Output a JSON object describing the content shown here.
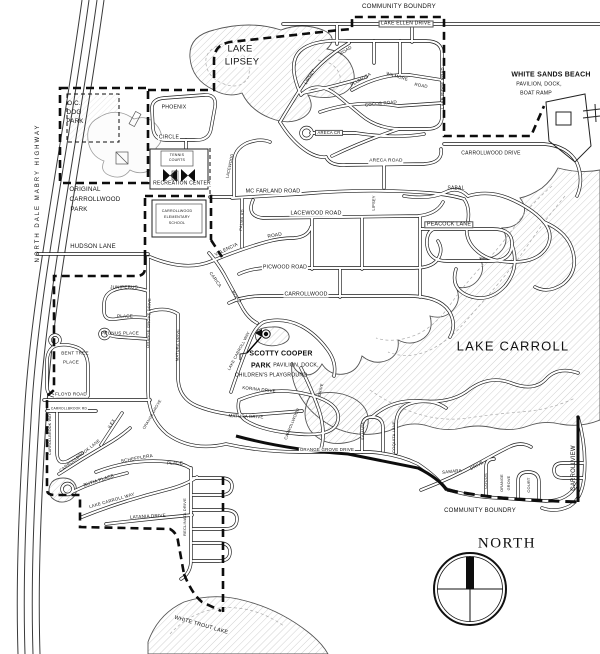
{
  "colors": {
    "ink": "#1b1b1b",
    "water_hatch": "#c4c4c4",
    "background": "#ffffff"
  },
  "map": {
    "labels": [
      {
        "id": "community-boundry-top",
        "t": "COMMUNITY BOUNDRY",
        "x": 399,
        "y": 7,
        "s": 6.2
      },
      {
        "id": "lake-ellen-drive",
        "t": "LAKE ELLEN DRIVE",
        "x": 406,
        "y": 24,
        "s": 5,
        "bx": 1
      },
      {
        "id": "white-sands-beach",
        "t": "WHITE SANDS BEACH",
        "x": 551,
        "y": 75,
        "s": 7,
        "w": 700
      },
      {
        "id": "white-sands-sub1",
        "t": "PAVILION, DOCK,",
        "x": 539,
        "y": 85,
        "s": 5.2
      },
      {
        "id": "white-sands-sub2",
        "t": "BOAT RAMP",
        "x": 536,
        "y": 94,
        "s": 5.2
      },
      {
        "id": "lake-lipsey-1",
        "t": "LAKE",
        "x": 240,
        "y": 49,
        "s": 9.5,
        "bg": 1
      },
      {
        "id": "lake-lipsey-2",
        "t": "LIPSEY",
        "x": 242,
        "y": 62,
        "s": 9.5,
        "bg": 1
      },
      {
        "id": "oc-dog-park-1",
        "t": "O.C.",
        "x": 74,
        "y": 104,
        "s": 6.2
      },
      {
        "id": "oc-dog-park-2",
        "t": "DOG",
        "x": 74,
        "y": 113,
        "s": 6.2
      },
      {
        "id": "oc-dog-park-3",
        "t": "PARK",
        "x": 75,
        "y": 122,
        "s": 6.2
      },
      {
        "id": "phoenix",
        "t": "PHOENIX",
        "x": 174,
        "y": 108,
        "s": 5.2,
        "bg": 1
      },
      {
        "id": "phoenix-circle",
        "t": "CIRCLE",
        "x": 169,
        "y": 138,
        "s": 5.2,
        "bg": 1
      },
      {
        "id": "tennis-1",
        "t": "TENNIS",
        "x": 177,
        "y": 156,
        "s": 3.6
      },
      {
        "id": "tennis-2",
        "t": "COURTS",
        "x": 177,
        "y": 161,
        "s": 3.6
      },
      {
        "id": "recreation-center",
        "t": "RECREATION CENTER",
        "x": 182,
        "y": 184,
        "s": 5,
        "bg": 1
      },
      {
        "id": "original-park-1",
        "t": "ORIGINAL",
        "x": 85,
        "y": 190,
        "s": 6.2
      },
      {
        "id": "original-park-2",
        "t": "CARROLLWOOD",
        "x": 95,
        "y": 200,
        "s": 6.2
      },
      {
        "id": "original-park-3",
        "t": "PARK",
        "x": 79,
        "y": 210,
        "s": 6.2
      },
      {
        "id": "school-1",
        "t": "CARROLLWOOD",
        "x": 177,
        "y": 212,
        "s": 3.6
      },
      {
        "id": "school-2",
        "t": "ELEMENTARY",
        "x": 177,
        "y": 218,
        "s": 3.6
      },
      {
        "id": "school-3",
        "t": "SCHOOL",
        "x": 177,
        "y": 224,
        "s": 3.6
      },
      {
        "id": "mc-farland-road",
        "t": "MC FARLAND ROAD",
        "x": 273,
        "y": 192,
        "s": 5.4,
        "bg": 1
      },
      {
        "id": "lacewood-road",
        "t": "LACEWOOD ROAD",
        "x": 316,
        "y": 214,
        "s": 5.4,
        "bg": 1
      },
      {
        "id": "lacewood-vert",
        "t": "LACEWOOD",
        "x": 230,
        "y": 166,
        "r": -78,
        "s": 4
      },
      {
        "id": "lipsey-vert",
        "t": "LIPSEY",
        "x": 374,
        "y": 203,
        "r": -88,
        "s": 4
      },
      {
        "id": "lipsey-road-1",
        "t": "LIPSEY",
        "x": 310,
        "y": 77,
        "r": -60,
        "s": 4.4
      },
      {
        "id": "lipsey-road-2",
        "t": "ROAD",
        "x": 346,
        "y": 51,
        "r": -32,
        "s": 4.4
      },
      {
        "id": "plumosa",
        "t": "PLUMOSA",
        "x": 361,
        "y": 80,
        "r": -30,
        "s": 4.4
      },
      {
        "id": "wilmore-1",
        "t": "WILMORE",
        "x": 397,
        "y": 77,
        "r": 16,
        "s": 4.4
      },
      {
        "id": "wilmore-2",
        "t": "ROAD",
        "x": 421,
        "y": 86,
        "r": 10,
        "s": 4.4
      },
      {
        "id": "cocos-road",
        "t": "COCOS ROAD",
        "x": 381,
        "y": 104,
        "r": -6,
        "s": 4.4
      },
      {
        "id": "areca-cr",
        "t": "ARECA CR",
        "x": 329,
        "y": 133,
        "s": 4.2,
        "bx": 1
      },
      {
        "id": "areca-road",
        "t": "ARECA ROAD",
        "x": 386,
        "y": 162,
        "s": 4.8,
        "bg": 1
      },
      {
        "id": "lake-ridge-road",
        "t": "LAKE RIDGE ROAD",
        "x": 443,
        "y": 88,
        "r": -90,
        "s": 4.2
      },
      {
        "id": "carrollwood-drive",
        "t": "CARROLLWOOD DRIVE",
        "x": 491,
        "y": 154,
        "s": 5
      },
      {
        "id": "sabal",
        "t": "SABAL",
        "x": 456,
        "y": 189,
        "s": 5
      },
      {
        "id": "peacock-lane",
        "t": "PEACOCK LANE",
        "x": 449,
        "y": 225,
        "s": 5.4,
        "bx": 1
      },
      {
        "id": "lake-carroll",
        "t": "LAKE CARROLL",
        "x": 513,
        "y": 346,
        "s": 13,
        "ls": 1.2
      },
      {
        "id": "north-dale-mabry-highway",
        "t": "NORTH DALE MABRY HIGHWAY",
        "x": 38,
        "y": 193,
        "r": -90,
        "s": 6,
        "ls": 2
      },
      {
        "id": "hudson-lane",
        "t": "HUDSON LANE",
        "x": 93,
        "y": 247,
        "s": 6,
        "bg": 1
      },
      {
        "id": "orange-grove-drive-vert",
        "t": "ORANGE GROVE DRIVE",
        "x": 149,
        "y": 323,
        "r": -88,
        "s": 4
      },
      {
        "id": "juniperus",
        "t": "JUNIPERUS",
        "x": 124,
        "y": 288,
        "s": 4.6
      },
      {
        "id": "juniperus-place",
        "t": "PLACE",
        "x": 125,
        "y": 317,
        "s": 4.6
      },
      {
        "id": "prunus-place",
        "t": "PRUNUS PLACE",
        "x": 120,
        "y": 334,
        "s": 4.6
      },
      {
        "id": "bent-tree-1",
        "t": "BENT TREE",
        "x": 75,
        "y": 354,
        "s": 4.6
      },
      {
        "id": "bent-tree-2",
        "t": "PLACE",
        "x": 71,
        "y": 363,
        "s": 4.6
      },
      {
        "id": "floyd-road",
        "t": "FLOYD ROAD",
        "x": 71,
        "y": 395,
        "s": 4.6,
        "bg": 1
      },
      {
        "id": "carrollbrook-rd",
        "t": "CARROLLBROOK RD",
        "x": 69,
        "y": 409,
        "s": 3.3,
        "bg": 1
      },
      {
        "id": "carrollbrook-way",
        "t": "CARROLLBROOK WAY",
        "x": 51,
        "y": 434,
        "r": -90,
        "s": 3.6
      },
      {
        "id": "carrollbrook-lane",
        "t": "CARROLLBROOK LANE",
        "x": 80,
        "y": 456,
        "r": -38,
        "s": 4.2
      },
      {
        "id": "ilex",
        "t": "ILEX",
        "x": 112,
        "y": 424,
        "r": -58,
        "s": 4.4
      },
      {
        "id": "schefflera",
        "t": "SCHEFFLERA",
        "x": 137,
        "y": 459,
        "r": -10,
        "s": 4.6
      },
      {
        "id": "schefflera-place",
        "t": "PLACE",
        "x": 175,
        "y": 464,
        "s": 4.6
      },
      {
        "id": "butia-place",
        "t": "BUTIA PLACE",
        "x": 99,
        "y": 481,
        "r": -18,
        "s": 4.6
      },
      {
        "id": "lake-carroll-way-s",
        "t": "LAKE CARROLL WAY",
        "x": 112,
        "y": 501,
        "r": -16,
        "s": 4.4
      },
      {
        "id": "latania-drive",
        "t": "LATANIA DRIVE",
        "x": 148,
        "y": 517,
        "r": -3,
        "s": 4.6
      },
      {
        "id": "reclinata-drive",
        "t": "RECLINATA DRIVE",
        "x": 185,
        "y": 517,
        "r": -90,
        "s": 4
      },
      {
        "id": "white-trout-lake",
        "t": "WHITE TROUT LAKE",
        "x": 201,
        "y": 626,
        "r": 16,
        "s": 5.4
      },
      {
        "id": "scotty-cooper-1",
        "t": "SCOTTY COOPER",
        "x": 281,
        "y": 354,
        "s": 7,
        "w": 700
      },
      {
        "id": "scotty-cooper-2",
        "t": "PARK",
        "x": 261,
        "y": 366,
        "s": 7,
        "w": 700
      },
      {
        "id": "scotty-cooper-3",
        "t": "PAVILION, DOCK,",
        "x": 296,
        "y": 366,
        "s": 5.2
      },
      {
        "id": "scotty-cooper-4",
        "t": "CHILDREN'S PLAYGROUND",
        "x": 271,
        "y": 376,
        "s": 5.2
      },
      {
        "id": "korina-drive",
        "t": "KORINA DRIVE",
        "x": 259,
        "y": 390,
        "r": 6,
        "s": 4.4
      },
      {
        "id": "matura-drive-h",
        "t": "MATURA DRIVE",
        "x": 246,
        "y": 417,
        "r": 2,
        "s": 4.4
      },
      {
        "id": "matura-drive-v",
        "t": "MATURA DRIVE",
        "x": 178,
        "y": 345,
        "r": -88,
        "s": 4
      },
      {
        "id": "lake-carroll-way-park",
        "t": "LAKE CARROLL WAY",
        "x": 239,
        "y": 351,
        "r": -62,
        "s": 4
      },
      {
        "id": "orange-grove-drive-h",
        "t": "ORANGE GROVE DRIVE",
        "x": 327,
        "y": 450,
        "s": 4.4,
        "bg": 1
      },
      {
        "id": "orange-grove-diag",
        "t": "ORANGE GROVE",
        "x": 153,
        "y": 415,
        "r": -60,
        "s": 3.8
      },
      {
        "id": "carrollwood-diag",
        "t": "CARROLLWOOD",
        "x": 292,
        "y": 424,
        "r": -68,
        "s": 4
      },
      {
        "id": "samara-vert",
        "t": "SAMARA",
        "x": 363,
        "y": 431,
        "r": -90,
        "s": 4
      },
      {
        "id": "coquita-lane",
        "t": "COQUITA LANE",
        "x": 394,
        "y": 437,
        "r": -90,
        "s": 4
      },
      {
        "id": "samara-drive-1",
        "t": "SAMARA",
        "x": 452,
        "y": 472,
        "r": -6,
        "s": 4.4
      },
      {
        "id": "samara-drive-2",
        "t": "DRIVE",
        "x": 477,
        "y": 466,
        "r": -28,
        "s": 4.4
      },
      {
        "id": "cocos-south",
        "t": "COCOS",
        "x": 486,
        "y": 481,
        "r": -90,
        "s": 4
      },
      {
        "id": "orange-grove-court-1",
        "t": "ORANGE",
        "x": 503,
        "y": 483,
        "r": -90,
        "s": 3.8
      },
      {
        "id": "orange-grove-court-2",
        "t": "GROVE",
        "x": 510,
        "y": 483,
        "r": -90,
        "s": 3.8
      },
      {
        "id": "orange-grove-court-3",
        "t": "COURT",
        "x": 529,
        "y": 485,
        "r": -90,
        "s": 4
      },
      {
        "id": "carrollview",
        "t": "CARROLLVIEW",
        "x": 574,
        "y": 468,
        "r": -90,
        "s": 6
      },
      {
        "id": "community-boundry-bottom",
        "t": "COMMUNITY BOUNDRY",
        "x": 480,
        "y": 511,
        "s": 6
      },
      {
        "id": "north-label",
        "t": "NORTH",
        "x": 507,
        "y": 544,
        "s": 15,
        "sf": 1,
        "ls": 1.5
      },
      {
        "id": "picwood-road",
        "t": "PICWOOD ROAD",
        "x": 285,
        "y": 268,
        "s": 5.2,
        "bg": 1
      },
      {
        "id": "carrollwood-mid",
        "t": "CARROLLWOOD",
        "x": 306,
        "y": 295,
        "s": 5.2,
        "bg": 1
      },
      {
        "id": "valencia-1",
        "t": "VALENCIA",
        "x": 227,
        "y": 251,
        "r": -26,
        "s": 4.8
      },
      {
        "id": "valencia-2",
        "t": "ROAD",
        "x": 275,
        "y": 237,
        "r": -10,
        "s": 4.8
      },
      {
        "id": "carica-1",
        "t": "CARICA",
        "x": 215,
        "y": 280,
        "r": 55,
        "s": 4.4
      },
      {
        "id": "carica-2",
        "t": "ROAD",
        "x": 236,
        "y": 297,
        "r": 55,
        "s": 4.4
      },
      {
        "id": "palma-rd",
        "t": "PALMA RD",
        "x": 242,
        "y": 220,
        "r": -85,
        "s": 4
      },
      {
        "id": "drive-lagoon",
        "t": "DRIVE",
        "x": 321,
        "y": 390,
        "r": -78,
        "s": 4
      }
    ]
  }
}
